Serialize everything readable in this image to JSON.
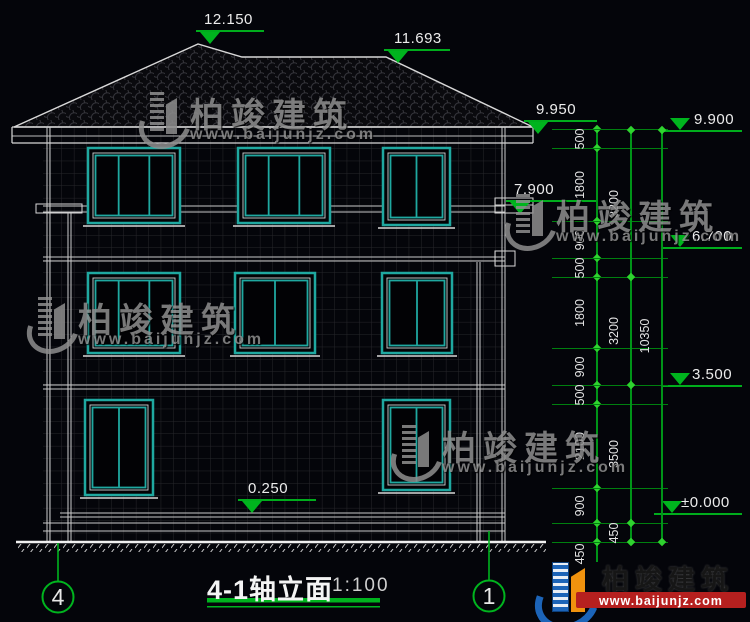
{
  "drawing_title": {
    "label": "4-1轴立面",
    "scale": "1:100"
  },
  "axis_bubbles": [
    {
      "label": "4",
      "cx": 58,
      "cy": 597
    },
    {
      "label": "1",
      "cx": 489,
      "cy": 596
    }
  ],
  "elevation_markers": [
    {
      "label": "12.150",
      "x1": 196,
      "x2": 264,
      "y": 30,
      "style": "left",
      "tx": 204,
      "ty": 11
    },
    {
      "label": "11.693",
      "x1": 384,
      "x2": 450,
      "y": 49,
      "style": "left",
      "tx": 394,
      "ty": 30
    },
    {
      "label": "9.950",
      "x1": 524,
      "x2": 597,
      "y": 120,
      "style": "left",
      "tx": 536,
      "ty": 101
    },
    {
      "label": "9.900",
      "x1": 662,
      "x2": 742,
      "y": 130,
      "style": "right",
      "tx": 694,
      "ty": 111
    },
    {
      "label": "7.900",
      "x1": 506,
      "x2": 597,
      "y": 200,
      "style": "left",
      "tx": 514,
      "ty": 181
    },
    {
      "label": "6.700",
      "x1": 662,
      "x2": 742,
      "y": 247,
      "style": "right",
      "tx": 692,
      "ty": 228
    },
    {
      "label": "3.500",
      "x1": 662,
      "x2": 742,
      "y": 385,
      "style": "right",
      "tx": 692,
      "ty": 366
    },
    {
      "label": "±0.000",
      "x1": 654,
      "x2": 742,
      "y": 513,
      "style": "right",
      "tx": 681,
      "ty": 494
    },
    {
      "label": "0.250",
      "x1": 238,
      "x2": 316,
      "y": 499,
      "style": "left",
      "tx": 248,
      "ty": 480
    }
  ],
  "dimension_columns": [
    {
      "x": 597,
      "ext_lines": true,
      "boundaries": [
        129,
        148,
        221,
        258,
        277,
        348,
        385,
        404,
        488,
        523,
        542
      ],
      "segments": [
        {
          "label": "500"
        },
        {
          "label": "1800"
        },
        {
          "label": "900"
        },
        {
          "label": "500"
        },
        {
          "label": "1800"
        },
        {
          "label": "900"
        },
        {
          "label": "500"
        },
        {
          "label": "2100"
        },
        {
          "label": "900"
        },
        {
          "label": "450",
          "label_y": 554
        }
      ]
    },
    {
      "x": 631,
      "ext_lines": false,
      "boundaries": [
        130,
        277,
        385,
        523,
        542
      ],
      "segments": [
        {
          "label": "3200"
        },
        {
          "label": "3200"
        },
        {
          "label": "3500"
        },
        {
          "label": "450"
        }
      ]
    },
    {
      "x": 662,
      "ext_lines": false,
      "boundaries": [
        130,
        542
      ],
      "segments": [
        {
          "label": "10350"
        }
      ]
    }
  ],
  "watermarks": [
    {
      "text": "柏竣建筑",
      "url": "www.baijunjz.com",
      "x": 140,
      "y": 88
    },
    {
      "text": "柏竣建筑",
      "url": "www.baijunjz.com",
      "x": 28,
      "y": 293
    },
    {
      "text": "柏竣建筑",
      "url": "www.baijunjz.com",
      "x": 392,
      "y": 421
    },
    {
      "text": "柏竣建筑",
      "url": "www.baijunjz.com",
      "x": 506,
      "y": 190
    }
  ],
  "footer_logo": {
    "company": "柏竣建筑",
    "url": "www.baijunjz.com"
  },
  "colors": {
    "dimension_green": "#00b41e",
    "tick_green": "#2fd32f",
    "window_teal": "#1fa8a0",
    "line_white": "#d4d4d4",
    "logo_blue": "#1c64b8",
    "logo_orange": "#f0920e",
    "logo_red": "#b6201f",
    "background": "#04050a"
  }
}
